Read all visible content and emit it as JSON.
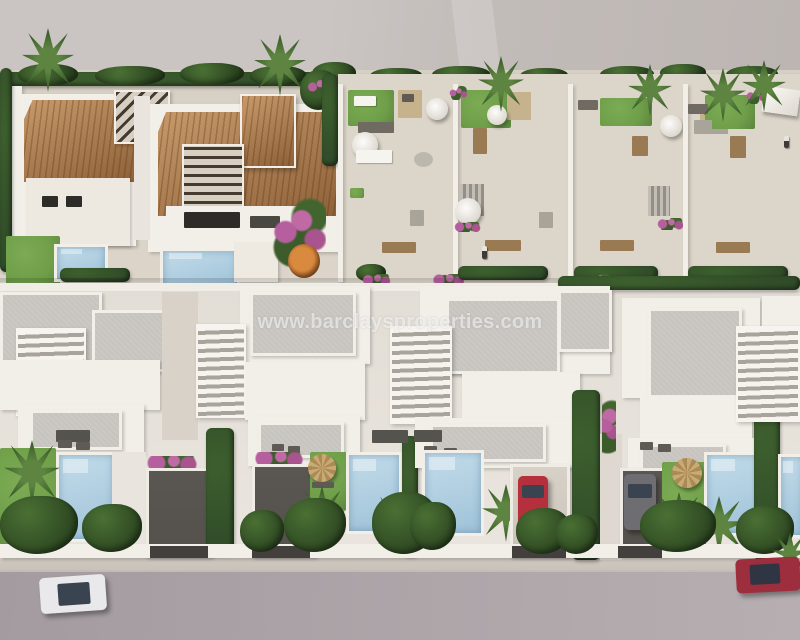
{
  "title": "Aerial 3D render of a new-build residential development",
  "watermark": {
    "text": "www.barclaysproperties.com"
  },
  "colors": {
    "open-land": "#c7c2bf",
    "garden-ground": "#dad3c8",
    "mid-ground": "#e7e2db",
    "wall-white": "#f2efe9",
    "roof-gray": "#c7c4bf",
    "terracotta-light": "#c79a6b",
    "terracotta-dark": "#8e6139",
    "lawn-green": "#6f9e49",
    "hedge-green": "#2f4a28",
    "palm-green": "#4e7a36",
    "pool-light": "#c2dcea",
    "pool-deep": "#9fc2d8",
    "driveway-dark": "#54504c",
    "road-gray": "#a8a1a4",
    "sidewalk-gray": "#d0c9c2",
    "car-white": "#e9e8ea",
    "car-red-driveway": "#b5303c",
    "car-red-road": "#9d2e3d",
    "car-grey": "#6d6d72",
    "straw": "#c2a26e",
    "bougainvillea": "#b65f9e",
    "stone-tan": "#c6b28c",
    "watermark-color": "rgba(255,255,255,0.55)"
  },
  "scene": {
    "rows": [
      "Mediterranean villas with terracotta tiled roofs and dark slatted pergolas (top left)",
      "Townhouses with roof terraces, lawns, parasols and outdoor furniture (top right)",
      "Modern white villas with white-slat pergolas, private pools and driveways (middle)",
      "Street with parked and passing cars (bottom)"
    ],
    "cars": [
      {
        "name": "white-car",
        "location": "road bottom-left",
        "color": "#e9e8ea"
      },
      {
        "name": "red-car",
        "location": "road bottom-right",
        "color": "#9d2e3d"
      },
      {
        "name": "red-car",
        "location": "villa driveway center",
        "color": "#b5303c"
      },
      {
        "name": "grey-car",
        "location": "villa driveway right",
        "color": "#6d6d72"
      }
    ]
  }
}
